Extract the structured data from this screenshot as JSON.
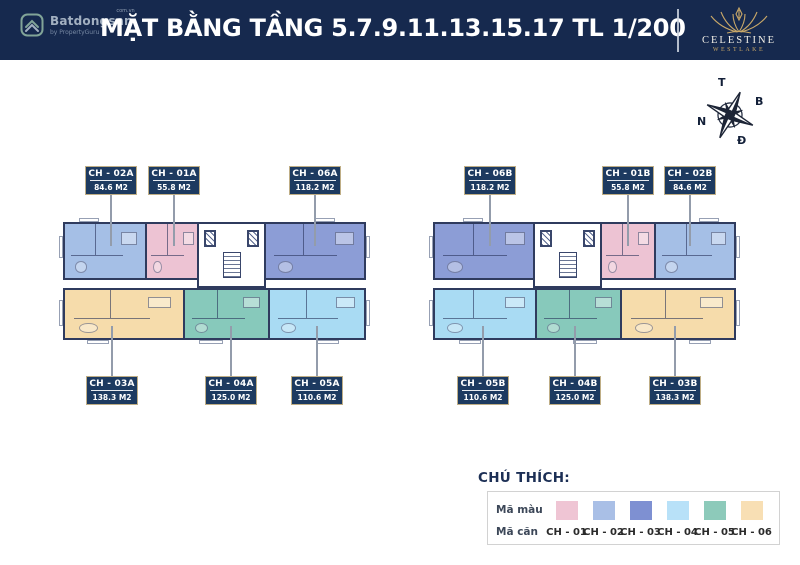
{
  "header": {
    "title": "MẶT BẰNG TẦNG 5.7.9.11.13.15.17 TL 1/200",
    "batdongsan": {
      "name": "Batdongsan",
      "suffix": "com.vn",
      "byline": "by PropertyGuru"
    },
    "celestine": {
      "name": "CELESTINE",
      "sub": "WESTLAKE"
    }
  },
  "compass": {
    "top": "T",
    "right": "B",
    "left": "N",
    "bottom": "Đ"
  },
  "plans": {
    "left": {
      "top_units": [
        {
          "code": "CH - 02A",
          "area": "84.6 M2",
          "color": "#a5bfe6"
        },
        {
          "code": "CH - 01A",
          "area": "55.8 M2",
          "color": "#edc3d3"
        },
        {
          "code": "CH - 06A",
          "area": "118.2 M2",
          "color": "#8c9dd6"
        }
      ],
      "bottom_units": [
        {
          "code": "CH - 03A",
          "area": "138.3 M2",
          "color": "#f6dcab"
        },
        {
          "code": "CH - 04A",
          "area": "125.0 M2",
          "color": "#87c9bb"
        },
        {
          "code": "CH - 05A",
          "area": "110.6 M2",
          "color": "#a9dbf3"
        }
      ]
    },
    "right": {
      "top_units": [
        {
          "code": "CH - 06B",
          "area": "118.2 M2",
          "color": "#8c9dd6"
        },
        {
          "code": "CH - 01B",
          "area": "55.8 M2",
          "color": "#edc3d3"
        },
        {
          "code": "CH - 02B",
          "area": "84.6 M2",
          "color": "#a5bfe6"
        }
      ],
      "bottom_units": [
        {
          "code": "CH - 05B",
          "area": "110.6 M2",
          "color": "#a9dbf3"
        },
        {
          "code": "CH - 04B",
          "area": "125.0 M2",
          "color": "#87c9bb"
        },
        {
          "code": "CH - 03B",
          "area": "138.3 M2",
          "color": "#f6dcab"
        }
      ]
    }
  },
  "legend": {
    "title": "CHÚ THÍCH:",
    "color_row_label": "Mã màu",
    "code_row_label": "Mã căn",
    "items": [
      {
        "code": "CH - 01",
        "color": "#efc5d4"
      },
      {
        "code": "CH - 02",
        "color": "#a9bfe6"
      },
      {
        "code": "CH - 03",
        "color": "#7e90d2"
      },
      {
        "code": "CH - 04",
        "color": "#b8e1f8"
      },
      {
        "code": "CH - 05",
        "color": "#8dcaba"
      },
      {
        "code": "CH - 06",
        "color": "#f8dfb4"
      }
    ]
  },
  "colors": {
    "header_bg": "#16294e",
    "tag_bg": "#1d3a60",
    "tag_border": "#bfae86",
    "wall": "#2f3b5e",
    "gold": "#c9a868"
  }
}
